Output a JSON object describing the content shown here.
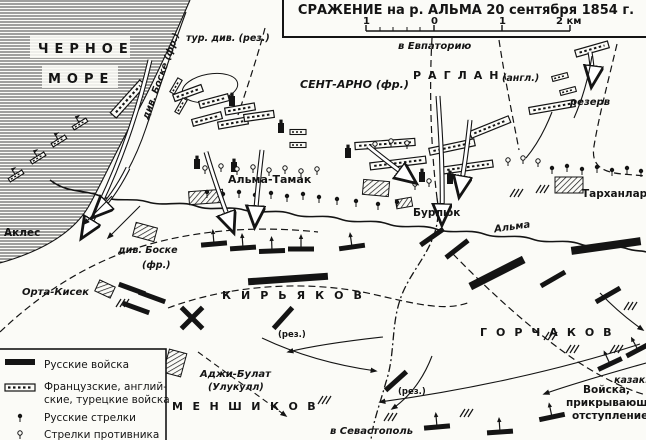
{
  "map": {
    "title": "СРАЖЕНИЕ на р. АЛЬМА 20 сентября 1854 г.",
    "scale": {
      "left1": "1",
      "zero": "0",
      "right1": "1",
      "right2": "2 км"
    },
    "sea": {
      "word1": "ЧЕРНОЕ",
      "word2": "МОРЕ"
    },
    "routes": {
      "to_evpatoria": "в Евпаторию",
      "to_sevastopol": "в Севастополь"
    },
    "places": {
      "alma_tamak": "Альма-Тамак",
      "burlyuk": "Бурлюк",
      "tarkhanlar": "Тарханлар",
      "akles": "Аклес",
      "orta_kisek": "Орта-Кисек",
      "adzhi_bulat": "Аджи-Булат",
      "ulukull": "(Улукулл)",
      "alma_river": "Альма"
    },
    "commanders": {
      "saint_arnaud": "СЕНТ-АРНО (фр.)",
      "raglan": "РАГЛАН",
      "raglan_suffix": "(англ.)",
      "kiryakov": "КИРЬЯКОВ",
      "gorchakov": "ГОРЧАКОВ",
      "menshikov": "МЕНШИКОВ"
    },
    "units": {
      "turkish_reserve": "тур. див. (рез.)",
      "bosquet_route": "див. Боске (фр.)",
      "bosquet_line1": "див. Боске",
      "bosquet_line2": "(фр.)",
      "reserve": "резерв",
      "rez1": "(рез.)",
      "rez2": "(рез.)",
      "cossacks": "казаки",
      "covering_line1": "Войска,",
      "covering_line2": "прикрывающие",
      "covering_line3": "отступление"
    },
    "legend": {
      "russian_troops": "Русские войска",
      "allied_line1": "Французские, англий-",
      "allied_line2": "ские, турецкие войска",
      "russian_riflemen": "Русские стрелки",
      "enemy_riflemen": "Стрелки противника"
    },
    "colors": {
      "ink": "#141414",
      "paper": "#fbfbf7"
    }
  }
}
